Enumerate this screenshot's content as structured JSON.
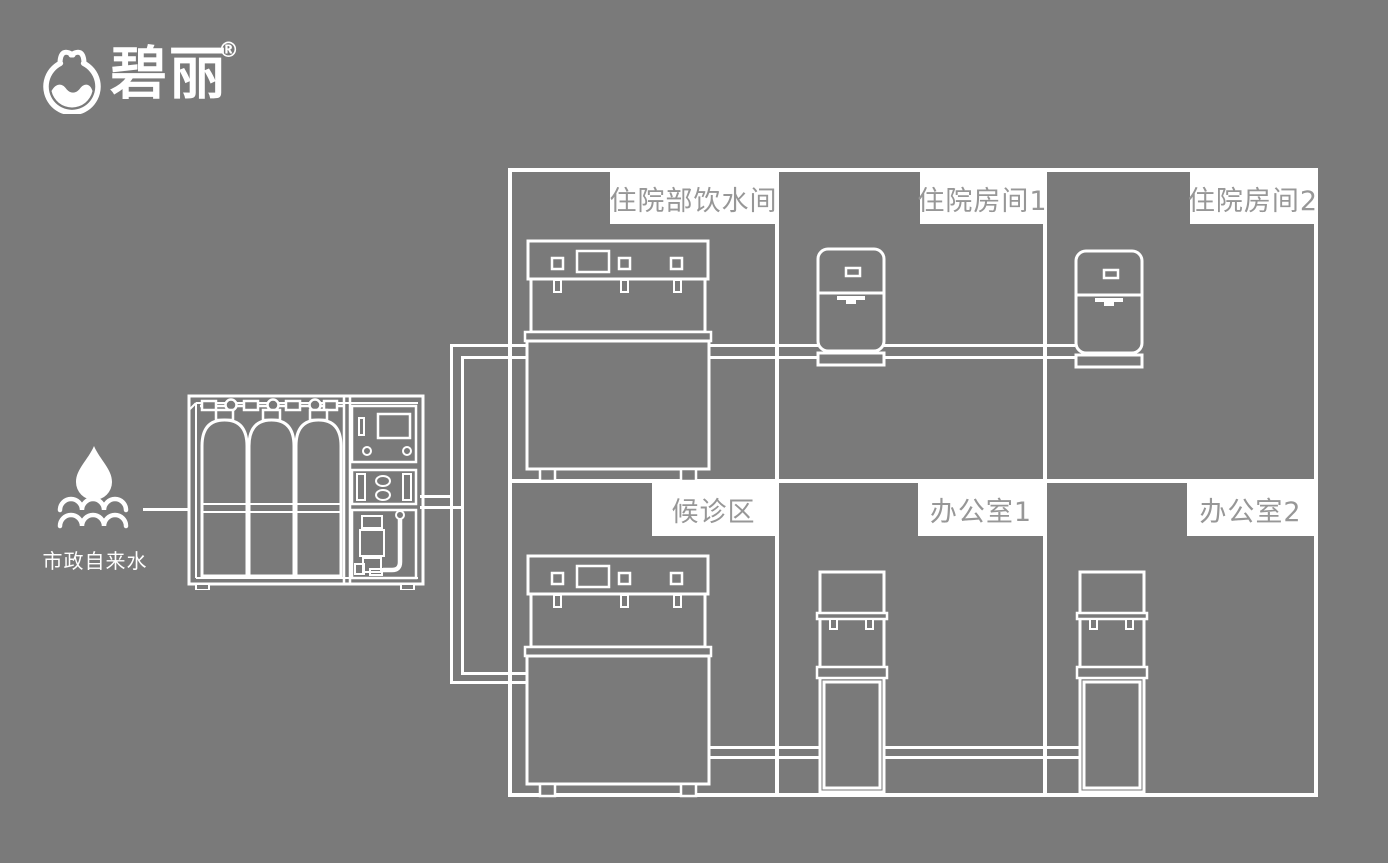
{
  "brand": {
    "logo_text": "碧丽",
    "registered_mark": "®",
    "logo_icon": "water-cup-circle-icon"
  },
  "source": {
    "label": "市政自来水",
    "icon": "water-drop-waves-icon"
  },
  "equipment": {
    "purifier_icon": "ro-water-treatment-machine",
    "connection": "pipe-loop"
  },
  "rooms": [
    {
      "id": "inpatient-water-room",
      "label": "住院部饮水间",
      "device_icon": "commercial-multi-tap-dispenser"
    },
    {
      "id": "inpatient-room-1",
      "label": "住院房间1",
      "device_icon": "countertop-dispenser"
    },
    {
      "id": "inpatient-room-2",
      "label": "住院房间2",
      "device_icon": "countertop-dispenser"
    },
    {
      "id": "waiting-area",
      "label": "候诊区",
      "device_icon": "commercial-multi-tap-dispenser"
    },
    {
      "id": "office-1",
      "label": "办公室1",
      "device_icon": "floor-standing-dispenser"
    },
    {
      "id": "office-2",
      "label": "办公室2",
      "device_icon": "floor-standing-dispenser"
    }
  ],
  "colors": {
    "background": "#7a7a7a",
    "line": "#ffffff",
    "label_background": "#ffffff",
    "label_text": "#979797"
  }
}
